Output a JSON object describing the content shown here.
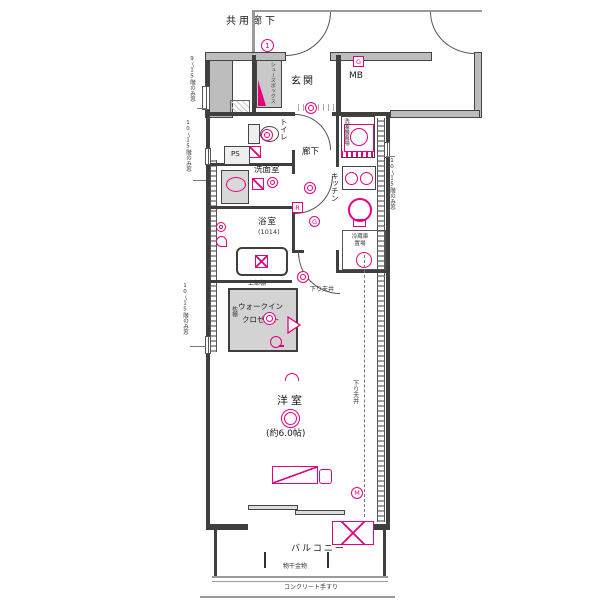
{
  "colors": {
    "accent": "#e6007e",
    "wall": "#3f3f3f"
  },
  "labels": {
    "corridor": "共用廊下",
    "entrance": "玄関",
    "shoe_box": "シューズボックス",
    "mb": "MB",
    "toilet": "トイレ",
    "hallway": "廊下",
    "ps": "PS",
    "washroom": "洗面室",
    "bathroom": "浴室",
    "bathroom_size": "(1014)",
    "kitchen": "キッチン",
    "washer": "洗濯機置場",
    "fridge": "冷蔵庫置場",
    "shelf_top": "上部棚",
    "shelf_side": "枕棚",
    "wic_line1": "ウォークイン",
    "wic_line2": "クロゼット",
    "lowered_ceiling": "下り天井",
    "bedroom": "洋室",
    "bedroom_size": "(約6.0帖)",
    "balcony": "バルコニー",
    "laundry_hardware": "物干金物",
    "handrail": "コンクリート手すり"
  },
  "markers": {
    "one": "1",
    "gas_box": "G",
    "remote": "R",
    "gas_round": "G",
    "meter": "M"
  },
  "annotations": {
    "left_top": "9〜15階のみ窓",
    "left_mid": "10〜15階のみ窓",
    "left_low": "10〜15階のみ窓",
    "right": "10〜15階のみ窓"
  }
}
